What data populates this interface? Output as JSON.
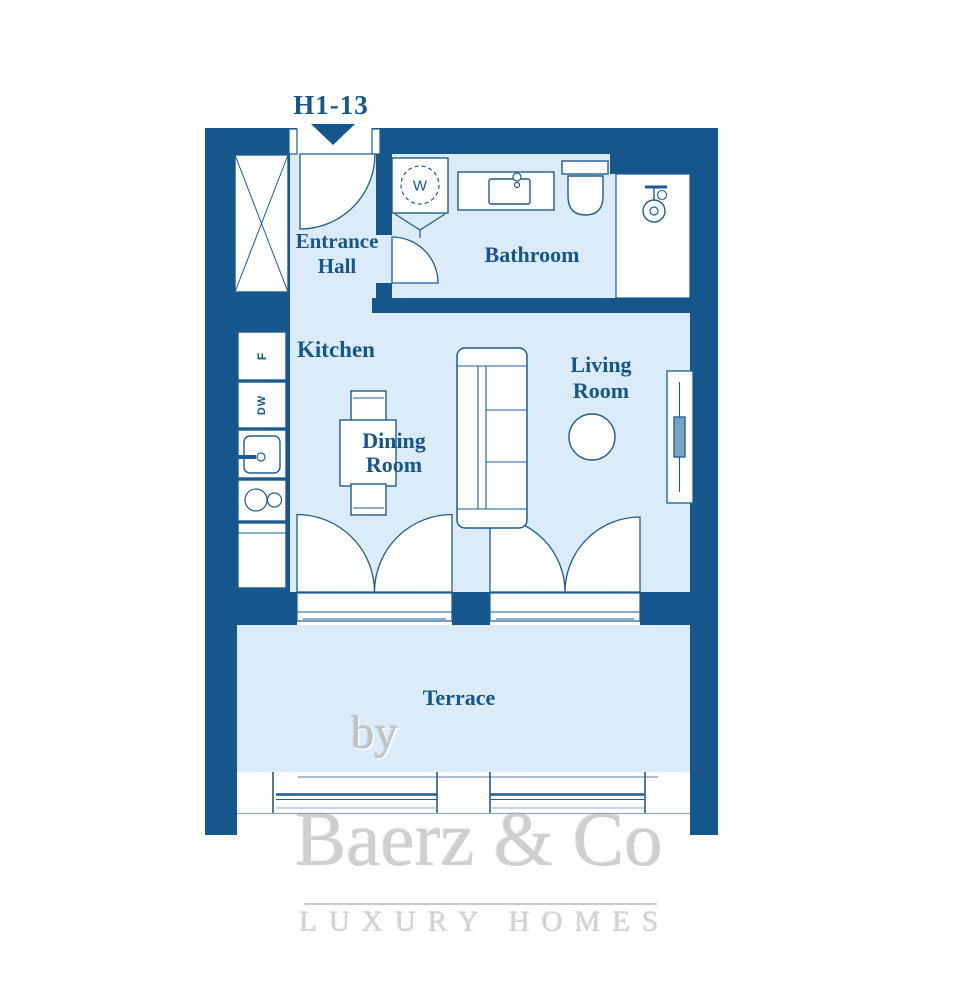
{
  "plan": {
    "unit_label": "H1-13",
    "rooms": {
      "entrance_hall": "Entrance Hall",
      "bathroom": "Bathroom",
      "kitchen": "Kitchen",
      "dining_room": "Dining Room",
      "living_room": "Living Room",
      "terrace": "Terrace"
    },
    "appliances": {
      "fridge": "F",
      "dishwasher": "DW",
      "washer": "W"
    },
    "colors": {
      "wall": "#15578C",
      "floor": "#DBEBF7",
      "line": "#1D5C8F",
      "label_text": "#15578C",
      "watermark_gray": "#C9C9C9"
    }
  },
  "watermark": {
    "by": "by",
    "brand": "Baerz & Co",
    "tagline": "LUXURY HOMES"
  }
}
